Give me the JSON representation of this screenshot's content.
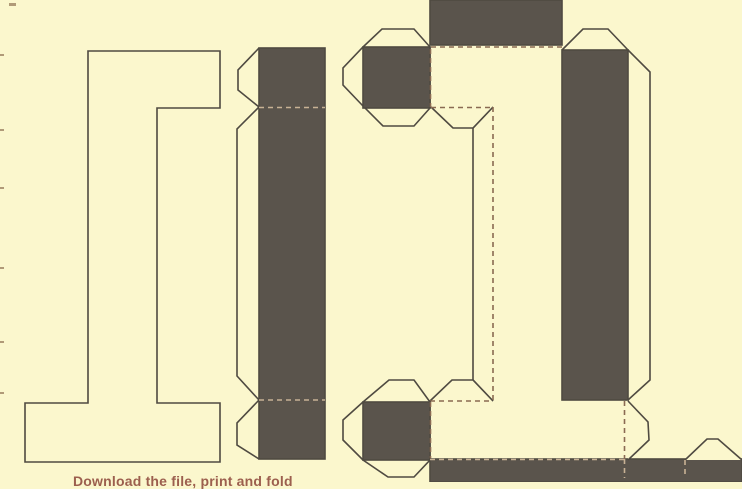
{
  "canvas": {
    "width": 742,
    "height": 482
  },
  "colors": {
    "bg": "#fbf7cd",
    "dark": "#5a544c",
    "stroke": "#4f4a41",
    "dashCream": "#8a6a52",
    "dashDark": "#c8b295",
    "caption": "#9c5f4e",
    "speck": "#b09a78"
  },
  "caption": {
    "text": "Download the file, print and fold"
  },
  "dash_pattern": "5,4",
  "shapes": [
    {
      "name": "background",
      "type": "rect",
      "x": 0,
      "y": 0,
      "w": 742,
      "h": 482,
      "fill": "bg",
      "stroke": false
    },
    {
      "name": "letter-i-front-face",
      "type": "poly",
      "closed": true,
      "fill": "bg",
      "stroke": true,
      "pts": [
        [
          88,
          51
        ],
        [
          220,
          51
        ],
        [
          220,
          108
        ],
        [
          157,
          108
        ],
        [
          157,
          403
        ],
        [
          220,
          403
        ],
        [
          220,
          462
        ],
        [
          25,
          462
        ],
        [
          25,
          403
        ],
        [
          88,
          403
        ]
      ]
    },
    {
      "name": "mid-strip-tab-top",
      "type": "poly",
      "closed": false,
      "fill": "bg",
      "stroke": true,
      "pts": [
        [
          259,
          48
        ],
        [
          238,
          70
        ],
        [
          238,
          90
        ],
        [
          259,
          107
        ]
      ]
    },
    {
      "name": "mid-strip-flap-left",
      "type": "poly",
      "closed": false,
      "fill": "bg",
      "stroke": true,
      "pts": [
        [
          259,
          107
        ],
        [
          237,
          129
        ],
        [
          237,
          376
        ],
        [
          259,
          400
        ]
      ]
    },
    {
      "name": "mid-strip-tab-bottom",
      "type": "poly",
      "closed": false,
      "fill": "bg",
      "stroke": true,
      "pts": [
        [
          259,
          400
        ],
        [
          237,
          423
        ],
        [
          237,
          445
        ],
        [
          259,
          459
        ]
      ]
    },
    {
      "name": "mid-strip-side-face",
      "type": "rect",
      "x": 259,
      "y": 48,
      "w": 66,
      "h": 411,
      "fill": "dark",
      "stroke": true
    },
    {
      "name": "mid-strip-fold-top",
      "type": "line",
      "x1": 259,
      "y1": 107.5,
      "x2": 325,
      "y2": 107.5,
      "color": "dashDark",
      "dashed": true
    },
    {
      "name": "mid-strip-fold-bottom",
      "type": "line",
      "x1": 259,
      "y1": 400,
      "x2": 325,
      "y2": 400,
      "color": "dashDark",
      "dashed": true
    },
    {
      "name": "back-top-face",
      "type": "rect",
      "x": 430,
      "y": 0,
      "w": 132,
      "h": 45,
      "fill": "dark",
      "stroke": true
    },
    {
      "name": "fold-top-bar-top",
      "type": "line",
      "x1": 431,
      "y1": 47,
      "x2": 562,
      "y2": 47,
      "color": "dashCream",
      "dashed": true
    },
    {
      "name": "top-serif-tab-ring",
      "type": "poly",
      "closed": true,
      "fill": "bg",
      "stroke": true,
      "pts": [
        [
          414,
          29
        ],
        [
          382,
          29
        ],
        [
          363,
          47
        ],
        [
          343,
          68
        ],
        [
          343,
          85
        ],
        [
          363,
          106
        ],
        [
          383,
          126
        ],
        [
          414,
          126
        ],
        [
          430,
          108
        ],
        [
          430,
          47
        ]
      ]
    },
    {
      "name": "top-serif-face",
      "type": "rect",
      "x": 363,
      "y": 47,
      "w": 67,
      "h": 61,
      "fill": "dark",
      "stroke": true
    },
    {
      "name": "fold-top-bar-left",
      "type": "line",
      "x1": 430.5,
      "y1": 49,
      "x2": 430.5,
      "y2": 107,
      "color": "dashCream",
      "dashed": true
    },
    {
      "name": "stem-flap-long",
      "type": "poly",
      "closed": false,
      "fill": "bg",
      "stroke": true,
      "pts": [
        [
          493,
          107
        ],
        [
          473,
          128
        ],
        [
          473,
          380
        ],
        [
          493,
          401
        ]
      ]
    },
    {
      "name": "stem-tab-top",
      "type": "poly",
      "closed": false,
      "fill": "bg",
      "stroke": true,
      "pts": [
        [
          431,
          107
        ],
        [
          453,
          128
        ],
        [
          473,
          128
        ],
        [
          493,
          107
        ]
      ]
    },
    {
      "name": "stem-tab-bottom",
      "type": "poly",
      "closed": false,
      "fill": "bg",
      "stroke": true,
      "pts": [
        [
          430,
          401
        ],
        [
          452,
          380
        ],
        [
          473,
          380
        ],
        [
          493,
          401
        ]
      ]
    },
    {
      "name": "fold-top-bar-bottom",
      "type": "line",
      "x1": 431,
      "y1": 107.5,
      "x2": 493,
      "y2": 107.5,
      "color": "dashCream",
      "dashed": true
    },
    {
      "name": "fold-stem-left",
      "type": "line",
      "x1": 493,
      "y1": 107,
      "x2": 493,
      "y2": 401,
      "color": "dashCream",
      "dashed": true
    },
    {
      "name": "fold-bottom-bar-top",
      "type": "line",
      "x1": 430,
      "y1": 401,
      "x2": 493,
      "y2": 401,
      "color": "dashCream",
      "dashed": true
    },
    {
      "name": "bottom-serif-tab-ring",
      "type": "poly",
      "closed": true,
      "fill": "bg",
      "stroke": true,
      "pts": [
        [
          414,
          380
        ],
        [
          389,
          380
        ],
        [
          363,
          402
        ],
        [
          343,
          420
        ],
        [
          343,
          440
        ],
        [
          363,
          460
        ],
        [
          388,
          477
        ],
        [
          414,
          477
        ],
        [
          430,
          460
        ],
        [
          430,
          402
        ]
      ]
    },
    {
      "name": "bottom-serif-face",
      "type": "rect",
      "x": 363,
      "y": 402,
      "w": 67,
      "h": 58,
      "fill": "dark",
      "stroke": true
    },
    {
      "name": "fold-bottom-bar-left",
      "type": "line",
      "x1": 430.5,
      "y1": 402,
      "x2": 430.5,
      "y2": 460,
      "color": "dashCream",
      "dashed": true
    },
    {
      "name": "right-strip-tab-top",
      "type": "poly",
      "closed": false,
      "fill": "bg",
      "stroke": true,
      "pts": [
        [
          562,
          50
        ],
        [
          583,
          29
        ],
        [
          608,
          29
        ],
        [
          628,
          50
        ]
      ]
    },
    {
      "name": "right-strip-flap",
      "type": "poly",
      "closed": false,
      "fill": "bg",
      "stroke": true,
      "pts": [
        [
          628,
          50
        ],
        [
          650,
          72
        ],
        [
          650,
          380
        ],
        [
          628,
          400
        ]
      ]
    },
    {
      "name": "right-strip-side-face",
      "type": "rect",
      "x": 562,
      "y": 50,
      "w": 66,
      "h": 350,
      "fill": "dark",
      "stroke": true
    },
    {
      "name": "bottom-band-face",
      "type": "rect",
      "x": 430,
      "y": 459,
      "w": 312,
      "h": 23,
      "fill": "dark",
      "stroke": true
    },
    {
      "name": "band-fold-left-segment",
      "type": "line",
      "x1": 430,
      "y1": 459.5,
      "x2": 628,
      "y2": 459.5,
      "color": "dashDark",
      "dashed": true
    },
    {
      "name": "band-tab-right",
      "type": "poly",
      "closed": false,
      "fill": "bg",
      "stroke": true,
      "pts": [
        [
          685,
          460
        ],
        [
          707,
          439
        ],
        [
          718,
          439
        ],
        [
          742,
          460
        ]
      ]
    },
    {
      "name": "right-hex-tab",
      "type": "poly",
      "closed": false,
      "fill": "bg",
      "stroke": true,
      "pts": [
        [
          628,
          401
        ],
        [
          648,
          422
        ],
        [
          649,
          440
        ],
        [
          628,
          460
        ]
      ]
    },
    {
      "name": "fold-bottom-bar-right-upper",
      "type": "line",
      "x1": 624.5,
      "y1": 401,
      "x2": 624.5,
      "y2": 459,
      "color": "dashCream",
      "dashed": true
    },
    {
      "name": "fold-bottom-bar-right-lower",
      "type": "line",
      "x1": 624.5,
      "y1": 459,
      "x2": 624.5,
      "y2": 478,
      "color": "dashDark",
      "dashed": true
    },
    {
      "name": "band-fold-inner",
      "type": "line",
      "x1": 685,
      "y1": 460,
      "x2": 685,
      "y2": 478,
      "color": "dashDark",
      "dashed": true
    }
  ],
  "edge_marks": [
    {
      "name": "edge-mark",
      "x": 9,
      "y": 3,
      "w": 7,
      "h": 3
    },
    {
      "name": "edge-mark",
      "x": 0,
      "y": 54,
      "w": 4,
      "h": 2
    },
    {
      "name": "edge-mark",
      "x": 0,
      "y": 129,
      "w": 4,
      "h": 2
    },
    {
      "name": "edge-mark",
      "x": 0,
      "y": 187,
      "w": 4,
      "h": 2
    },
    {
      "name": "edge-mark",
      "x": 0,
      "y": 267,
      "w": 4,
      "h": 2
    },
    {
      "name": "edge-mark",
      "x": 0,
      "y": 341,
      "w": 4,
      "h": 2
    },
    {
      "name": "edge-mark",
      "x": 0,
      "y": 392,
      "w": 4,
      "h": 2
    }
  ]
}
